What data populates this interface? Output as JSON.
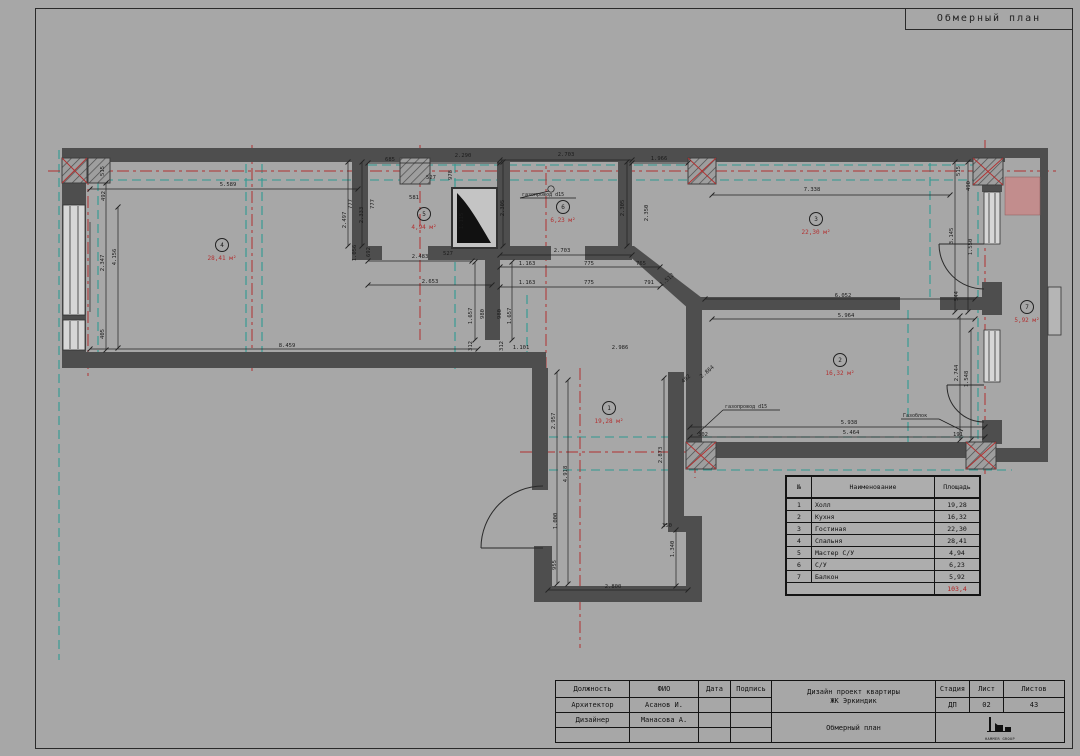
{
  "page": {
    "sheet_title": "Обмерный план"
  },
  "rooms": [
    {
      "num": "1",
      "area": "19,28 м²",
      "x": 609,
      "y": 408
    },
    {
      "num": "2",
      "area": "16,32 м²",
      "x": 840,
      "y": 360
    },
    {
      "num": "3",
      "area": "22,30 м²",
      "x": 816,
      "y": 219
    },
    {
      "num": "4",
      "area": "28,41 м²",
      "x": 222,
      "y": 245
    },
    {
      "num": "5",
      "area": "4,94 м²",
      "x": 424,
      "y": 214
    },
    {
      "num": "6",
      "area": "6,23 м²",
      "x": 563,
      "y": 207
    },
    {
      "num": "7",
      "area": "5,92 м²",
      "x": 1027,
      "y": 307
    }
  ],
  "annotations": [
    {
      "t": "газопровод d15",
      "x": 522,
      "y": 196
    },
    {
      "t": "газопровод d15",
      "x": 725,
      "y": 408
    },
    {
      "t": "Газоблок",
      "x": 903,
      "y": 417
    }
  ],
  "dimensions": [
    {
      "t": "5.589",
      "x": 228,
      "y": 186
    },
    {
      "t": "685",
      "x": 390,
      "y": 161
    },
    {
      "t": "2.290",
      "x": 463,
      "y": 157
    },
    {
      "t": "527",
      "x": 431,
      "y": 179
    },
    {
      "t": "978",
      "x": 452,
      "y": 175,
      "r": -90
    },
    {
      "t": "581",
      "x": 414,
      "y": 199
    },
    {
      "t": "2.703",
      "x": 566,
      "y": 156
    },
    {
      "t": "1.966",
      "x": 659,
      "y": 160
    },
    {
      "t": "7.338",
      "x": 812,
      "y": 191
    },
    {
      "t": "2.703",
      "x": 562,
      "y": 252
    },
    {
      "t": "527",
      "x": 448,
      "y": 255
    },
    {
      "t": "1.163",
      "x": 527,
      "y": 265
    },
    {
      "t": "775",
      "x": 589,
      "y": 265
    },
    {
      "t": "765",
      "x": 641,
      "y": 265
    },
    {
      "t": "1.163",
      "x": 527,
      "y": 284
    },
    {
      "t": "775",
      "x": 589,
      "y": 284
    },
    {
      "t": "791",
      "x": 649,
      "y": 284
    },
    {
      "t": "2.483",
      "x": 420,
      "y": 258
    },
    {
      "t": "2.653",
      "x": 430,
      "y": 283
    },
    {
      "t": "8.459",
      "x": 287,
      "y": 347
    },
    {
      "t": "1.101",
      "x": 521,
      "y": 349
    },
    {
      "t": "2.986",
      "x": 620,
      "y": 349
    },
    {
      "t": "6.052",
      "x": 843,
      "y": 297
    },
    {
      "t": "5.964",
      "x": 846,
      "y": 317
    },
    {
      "t": "5.938",
      "x": 849,
      "y": 424
    },
    {
      "t": "5.464",
      "x": 851,
      "y": 434
    },
    {
      "t": "302",
      "x": 703,
      "y": 436
    },
    {
      "t": "191",
      "x": 958,
      "y": 436
    },
    {
      "t": "2.800",
      "x": 613,
      "y": 588
    },
    {
      "t": "350",
      "x": 667,
      "y": 527
    },
    {
      "t": "515",
      "x": 104,
      "y": 171,
      "r": -90
    },
    {
      "t": "492",
      "x": 105,
      "y": 196,
      "r": -90
    },
    {
      "t": "2.347",
      "x": 104,
      "y": 263,
      "r": -90
    },
    {
      "t": "4.156",
      "x": 116,
      "y": 257,
      "r": -90
    },
    {
      "t": "405",
      "x": 104,
      "y": 334,
      "r": -90
    },
    {
      "t": "777",
      "x": 352,
      "y": 204,
      "r": -90
    },
    {
      "t": "777",
      "x": 374,
      "y": 204,
      "r": -90
    },
    {
      "t": "2.333",
      "x": 363,
      "y": 215,
      "r": -90
    },
    {
      "t": "2.497",
      "x": 346,
      "y": 220,
      "r": -90
    },
    {
      "t": "1.056",
      "x": 356,
      "y": 253,
      "r": -90
    },
    {
      "t": "692",
      "x": 370,
      "y": 252,
      "r": -90
    },
    {
      "t": "1.115",
      "x": 463,
      "y": 221,
      "r": -90
    },
    {
      "t": "2.305",
      "x": 504,
      "y": 208,
      "r": -90
    },
    {
      "t": "2.305",
      "x": 624,
      "y": 208,
      "r": -90
    },
    {
      "t": "2.350",
      "x": 648,
      "y": 213,
      "r": -90
    },
    {
      "t": "515",
      "x": 960,
      "y": 171,
      "r": -90
    },
    {
      "t": "490",
      "x": 970,
      "y": 186,
      "r": -90
    },
    {
      "t": "3.145",
      "x": 953,
      "y": 236,
      "r": -90
    },
    {
      "t": "1.550",
      "x": 972,
      "y": 247,
      "r": -90
    },
    {
      "t": "544",
      "x": 958,
      "y": 296,
      "r": -90
    },
    {
      "t": "2.744",
      "x": 958,
      "y": 373,
      "r": -90
    },
    {
      "t": "1.548",
      "x": 968,
      "y": 379,
      "r": -90
    },
    {
      "t": "2.957",
      "x": 555,
      "y": 421,
      "r": -90
    },
    {
      "t": "4.918",
      "x": 567,
      "y": 474,
      "r": -90
    },
    {
      "t": "1.000",
      "x": 557,
      "y": 521,
      "r": -90
    },
    {
      "t": "955",
      "x": 556,
      "y": 565,
      "r": -90
    },
    {
      "t": "1.340",
      "x": 674,
      "y": 549,
      "r": -90
    },
    {
      "t": "2.873",
      "x": 662,
      "y": 455,
      "r": -90
    },
    {
      "t": "1.657",
      "x": 472,
      "y": 316,
      "r": -90
    },
    {
      "t": "980",
      "x": 484,
      "y": 314,
      "r": -90
    },
    {
      "t": "980",
      "x": 501,
      "y": 314,
      "r": -90
    },
    {
      "t": "1.657",
      "x": 511,
      "y": 316,
      "r": -90
    },
    {
      "t": "312",
      "x": 472,
      "y": 346,
      "r": -90
    },
    {
      "t": "312",
      "x": 503,
      "y": 346,
      "r": -90
    },
    {
      "t": "1.512",
      "x": 668,
      "y": 281,
      "r": -40
    },
    {
      "t": "2.864",
      "x": 708,
      "y": 373,
      "r": -40
    },
    {
      "t": "492",
      "x": 687,
      "y": 380,
      "r": -40
    }
  ],
  "area_table": {
    "headers": [
      "№",
      "Наименование",
      "Площадь"
    ],
    "rows": [
      [
        "1",
        "Холл",
        "19,28"
      ],
      [
        "2",
        "Кухня",
        "16,32"
      ],
      [
        "3",
        "Гостиная",
        "22,30"
      ],
      [
        "4",
        "Спальня",
        "28,41"
      ],
      [
        "5",
        "Мастер С/У",
        "4,94"
      ],
      [
        "6",
        "С/У",
        "6,23"
      ],
      [
        "7",
        "Балкон",
        "5,92"
      ]
    ],
    "total": "103,4"
  },
  "title_block": {
    "headers": {
      "role": "Должность",
      "name": "ФИО",
      "date": "Дата",
      "sign": "Подпись",
      "stage": "Стадия",
      "sheet": "Лист",
      "sheets": "Листов"
    },
    "rows": [
      {
        "role": "Архитектор",
        "name": "Асанов И."
      },
      {
        "role": "Дизайнер",
        "name": "Манасова А."
      }
    ],
    "project_line1": "Дизайн проект квартиры",
    "project_line2": "ЖК Эркиндик",
    "drawing_name": "Обмерный план",
    "stage_value": "ДП",
    "sheet_value": "02",
    "sheets_value": "43",
    "logo_text": "HAMMER GROUP"
  },
  "colors": {
    "accent_red": "#b23030",
    "teal": "#2f9a92",
    "wall": "#4e4e4e",
    "pink_highlight": "#c28d8d"
  }
}
